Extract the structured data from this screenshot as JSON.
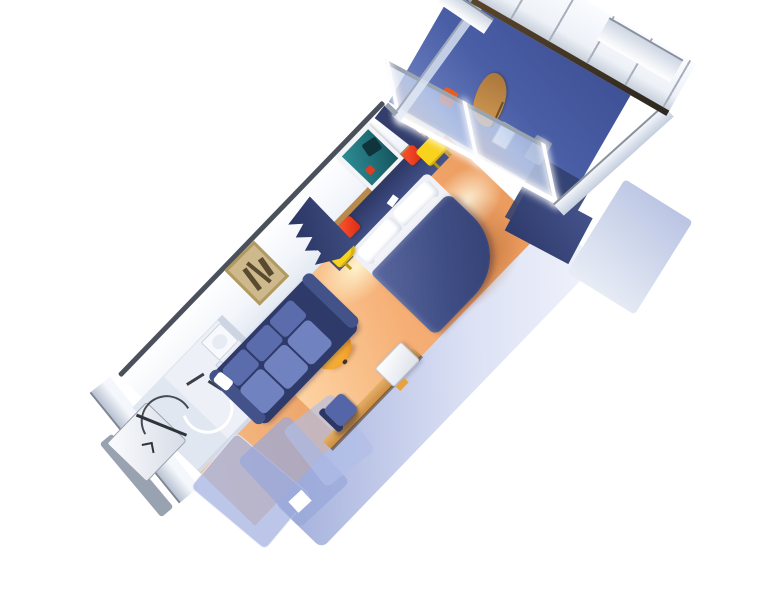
{
  "meta": {
    "scene_type": "3d-floorplan-render",
    "description": "Isometric cutaway rendering of a cruise-ship balcony stateroom, rotated diagonally on a white background. No text, labels or UI controls are visible in the image.",
    "view": "isometric top-down, room axis running from lower-left (entry) to upper-right (balcony)"
  },
  "palette": {
    "background": "#ffffff",
    "carpet_light": "#ffddae",
    "carpet_mid": "#f5ae74",
    "carpet_deep": "#ea985a",
    "bed_navy_dark": "#313e6e",
    "bed_navy": "#3e4c84",
    "bed_navy_light": "#5a689f",
    "linen_white": "#ffffff",
    "red_cube": "#d92b12",
    "yellow_table": "#f8d21c",
    "sofa_frame": "#2e3a6a",
    "sofa_cushion": "#5a6cab",
    "sofa_cushion_light": "#7082bf",
    "ottoman_orange": "#f2a52e",
    "desk_tan": "#d9a055",
    "chair_blue": "#5566a8",
    "wall_white": "#f7f9fc",
    "wall_edge_dark": "#4b515c",
    "periwinkle": "#a9b4dd",
    "balcony_floor": "#4a5ea6",
    "balcony_wood": "#a9763a",
    "rail_dark": "#2c2720",
    "glass_blue": "#c3d2ec",
    "bath_floor": "#edf0f6",
    "teal_art": "#2d8d95",
    "gold_art": "#cdb98c",
    "trim_tan": "#b98a4e"
  },
  "rooms": [
    {
      "name": "entry",
      "items": [
        "entry-step-platform",
        "door-swing-arc",
        "entry-door-edge",
        "chevron-mark"
      ]
    },
    {
      "name": "bathroom",
      "items": [
        "shower-stall",
        "shower-curtain-arc",
        "toilet",
        "sink",
        "towel-bars",
        "bathroom-door"
      ]
    },
    {
      "name": "corridor",
      "items": [
        "wardrobe-closet-panel-1",
        "wardrobe-closet-panel-2",
        "wardrobe-closet-panel-3"
      ]
    },
    {
      "name": "living-area",
      "items": [
        "sofa",
        "gold-framed-picture",
        "round-ottoman",
        "vanity-desk",
        "desk-chair",
        "white-cabinet"
      ]
    },
    {
      "name": "sleeping-area",
      "items": [
        "double-bed",
        "pillows",
        "red-cube-left",
        "red-cube-right",
        "yellow-nightstand-left",
        "yellow-nightstand-right",
        "navy-curtain",
        "teal-framed-picture",
        "headboard-wall"
      ]
    },
    {
      "name": "balcony",
      "items": [
        "sliding-glass-door",
        "balcony-floor",
        "wooden-chair",
        "orange-cushion",
        "balcony-table",
        "balcony-railing",
        "glass-partition",
        "neighbor-partition"
      ]
    }
  ]
}
